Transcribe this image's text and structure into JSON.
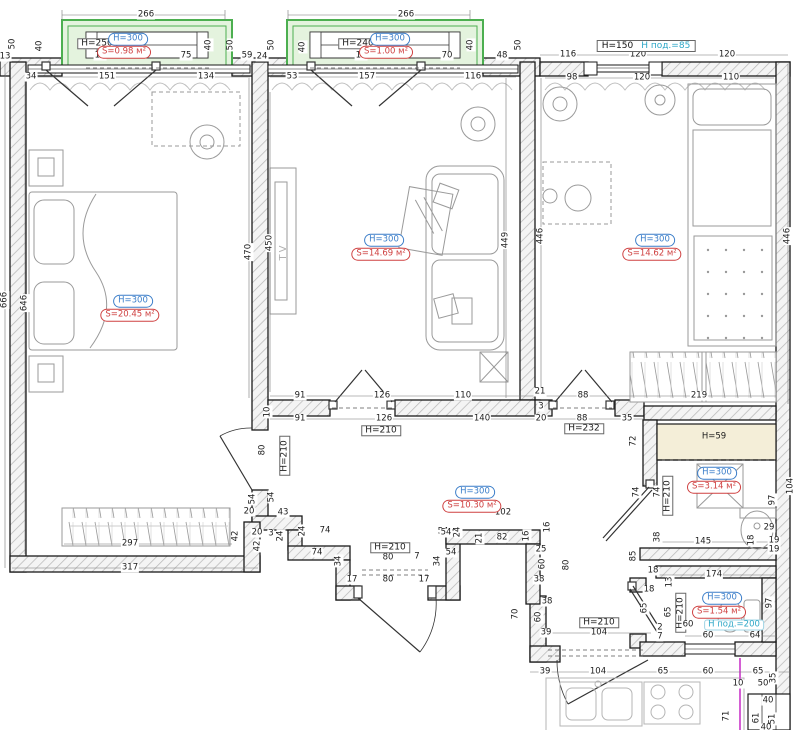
{
  "title": "apartment-floor-plan",
  "colors": {
    "wall_line": "#1a1a1a",
    "hatch": "#b9b9b9",
    "balcony_green": "#4caf50",
    "balcony_fill": "#e4f3de",
    "label_blue": "#3a7dc9",
    "label_red": "#cf4040",
    "teal": "#2da7c7",
    "shaft_fill": "#f4eed8",
    "furniture": "#9a9a9a",
    "magenta": "#d45fd4"
  },
  "window_label": {
    "h": "H=150",
    "sub": "Н под.=85"
  },
  "shaft_label": "H=59",
  "rooms": [
    {
      "id": "bedroom",
      "h": "H=300",
      "s": "S=20.45 м²",
      "hx": 133,
      "hy": 301,
      "sx": 130,
      "sy": 315
    },
    {
      "id": "living",
      "h": "H=300",
      "s": "S=14.69 м²",
      "hx": 384,
      "hy": 240,
      "sx": 381,
      "sy": 254
    },
    {
      "id": "bedroom-2",
      "h": "H=300",
      "s": "S=14.62 м²",
      "hx": 655,
      "hy": 240,
      "sx": 652,
      "sy": 254
    },
    {
      "id": "hallway",
      "h": "H=300",
      "s": "S=10.30 м²",
      "hx": 475,
      "hy": 492,
      "sx": 472,
      "sy": 506
    },
    {
      "id": "bathroom",
      "h": "H=300",
      "s": "S=3.14 м²",
      "hx": 717,
      "hy": 473,
      "sx": 714,
      "sy": 487
    },
    {
      "id": "wc",
      "h": "H=300",
      "s": "S=1.54 м²",
      "hx": 722,
      "hy": 598,
      "sx": 719,
      "sy": 612
    },
    {
      "id": "balcony-1",
      "h": "H=300",
      "s": "S=0.98 м²",
      "hx": 128,
      "hy": 39,
      "sx": 124,
      "sy": 52
    },
    {
      "id": "balcony-2",
      "h": "H=300",
      "s": "S=1.00 м²",
      "hx": 390,
      "hy": 39,
      "sx": 386,
      "sy": 52
    }
  ],
  "dimensions": [
    {
      "t": "266",
      "x": 146,
      "y": 15
    },
    {
      "t": "50",
      "x": 13,
      "y": 44,
      "v": 1
    },
    {
      "t": "13",
      "x": 5,
      "y": 57
    },
    {
      "t": "40",
      "x": 40,
      "y": 46,
      "v": 1
    },
    {
      "t": "H=250",
      "x": 97,
      "y": 44,
      "cls": "hbox"
    },
    {
      "t": "15",
      "x": 100,
      "y": 56
    },
    {
      "t": "75",
      "x": 186,
      "y": 56
    },
    {
      "t": "40",
      "x": 209,
      "y": 45,
      "v": 1
    },
    {
      "t": "50",
      "x": 231,
      "y": 45,
      "v": 1
    },
    {
      "t": "59",
      "x": 247,
      "y": 56
    },
    {
      "t": "34",
      "x": 31,
      "y": 77
    },
    {
      "t": "151",
      "x": 107,
      "y": 77
    },
    {
      "t": "134",
      "x": 206,
      "y": 77
    },
    {
      "t": "266",
      "x": 406,
      "y": 15
    },
    {
      "t": "50",
      "x": 272,
      "y": 45,
      "v": 1
    },
    {
      "t": "24",
      "x": 262,
      "y": 57
    },
    {
      "t": "40",
      "x": 303,
      "y": 47,
      "v": 1
    },
    {
      "t": "H=240",
      "x": 358,
      "y": 44,
      "cls": "hbox"
    },
    {
      "t": "15",
      "x": 361,
      "y": 56
    },
    {
      "t": "70",
      "x": 447,
      "y": 56
    },
    {
      "t": "40",
      "x": 471,
      "y": 45,
      "v": 1
    },
    {
      "t": "50",
      "x": 519,
      "y": 45,
      "v": 1
    },
    {
      "t": "48",
      "x": 502,
      "y": 56
    },
    {
      "t": "53",
      "x": 292,
      "y": 77
    },
    {
      "t": "157",
      "x": 367,
      "y": 77
    },
    {
      "t": "116",
      "x": 473,
      "y": 77
    },
    {
      "t": "116",
      "x": 568,
      "y": 55
    },
    {
      "t": "120",
      "x": 638,
      "y": 55
    },
    {
      "t": "120",
      "x": 727,
      "y": 55
    },
    {
      "t": "98",
      "x": 572,
      "y": 78
    },
    {
      "t": "120",
      "x": 642,
      "y": 78
    },
    {
      "t": "110",
      "x": 731,
      "y": 78
    },
    {
      "t": "666",
      "x": 5,
      "y": 300,
      "v": 1
    },
    {
      "t": "646",
      "x": 25,
      "y": 303,
      "v": 1
    },
    {
      "t": "470",
      "x": 249,
      "y": 252,
      "v": 1
    },
    {
      "t": "450",
      "x": 270,
      "y": 243,
      "v": 1
    },
    {
      "t": "TV",
      "x": 284,
      "y": 252,
      "v": 1,
      "cls": "tvtext"
    },
    {
      "t": "449",
      "x": 506,
      "y": 240,
      "v": 1
    },
    {
      "t": "446",
      "x": 541,
      "y": 236,
      "v": 1
    },
    {
      "t": "446",
      "x": 788,
      "y": 236,
      "v": 1
    },
    {
      "t": "91",
      "x": 300,
      "y": 396
    },
    {
      "t": "126",
      "x": 382,
      "y": 396
    },
    {
      "t": "110",
      "x": 463,
      "y": 396
    },
    {
      "t": "21",
      "x": 540,
      "y": 392
    },
    {
      "t": "88",
      "x": 583,
      "y": 396
    },
    {
      "t": "219",
      "x": 699,
      "y": 396
    },
    {
      "t": "91",
      "x": 300,
      "y": 419
    },
    {
      "t": "126",
      "x": 384,
      "y": 419
    },
    {
      "t": "140",
      "x": 482,
      "y": 419
    },
    {
      "t": "3",
      "x": 541,
      "y": 407
    },
    {
      "t": "20",
      "x": 541,
      "y": 419
    },
    {
      "t": "88",
      "x": 582,
      "y": 419
    },
    {
      "t": "35",
      "x": 627,
      "y": 419
    },
    {
      "t": "H=210",
      "x": 381,
      "y": 431,
      "cls": "hbox"
    },
    {
      "t": "H=232",
      "x": 584,
      "y": 429,
      "cls": "hbox"
    },
    {
      "t": "72",
      "x": 634,
      "y": 441,
      "v": 1
    },
    {
      "t": "H=59",
      "x": 714,
      "y": 437,
      "cls": "plain"
    },
    {
      "t": "10",
      "x": 268,
      "y": 412,
      "v": 1
    },
    {
      "t": "80",
      "x": 263,
      "y": 450,
      "v": 1
    },
    {
      "t": "H=210",
      "x": 285,
      "y": 456,
      "v": 1,
      "cls": "hbox"
    },
    {
      "t": "74",
      "x": 637,
      "y": 492,
      "v": 1
    },
    {
      "t": "74",
      "x": 658,
      "y": 492,
      "v": 1
    },
    {
      "t": "H=210",
      "x": 668,
      "y": 496,
      "v": 1,
      "cls": "hbox"
    },
    {
      "t": "97",
      "x": 773,
      "y": 500,
      "v": 1
    },
    {
      "t": "29",
      "x": 769,
      "y": 528
    },
    {
      "t": "38",
      "x": 658,
      "y": 537,
      "v": 1
    },
    {
      "t": "145",
      "x": 703,
      "y": 542
    },
    {
      "t": "18",
      "x": 752,
      "y": 540,
      "v": 1
    },
    {
      "t": "19",
      "x": 774,
      "y": 541
    },
    {
      "t": "19",
      "x": 774,
      "y": 550
    },
    {
      "t": "104",
      "x": 791,
      "y": 486,
      "v": 1
    },
    {
      "t": "85",
      "x": 634,
      "y": 556,
      "v": 1
    },
    {
      "t": "102",
      "x": 503,
      "y": 513
    },
    {
      "t": "54",
      "x": 443,
      "y": 532
    },
    {
      "t": "16",
      "x": 527,
      "y": 536,
      "v": 1
    },
    {
      "t": "16",
      "x": 548,
      "y": 527,
      "v": 1
    },
    {
      "t": "21",
      "x": 480,
      "y": 538,
      "v": 1
    },
    {
      "t": "82",
      "x": 502,
      "y": 538
    },
    {
      "t": "25",
      "x": 541,
      "y": 550
    },
    {
      "t": "60",
      "x": 543,
      "y": 564,
      "v": 1
    },
    {
      "t": "80",
      "x": 567,
      "y": 565,
      "v": 1
    },
    {
      "t": "38",
      "x": 539,
      "y": 580
    },
    {
      "t": "38",
      "x": 547,
      "y": 602
    },
    {
      "t": "60",
      "x": 539,
      "y": 617,
      "v": 1
    },
    {
      "t": "70",
      "x": 516,
      "y": 614,
      "v": 1
    },
    {
      "t": "39",
      "x": 546,
      "y": 633
    },
    {
      "t": "H=210",
      "x": 599,
      "y": 623,
      "cls": "hbox"
    },
    {
      "t": "104",
      "x": 599,
      "y": 633
    },
    {
      "t": "297",
      "x": 130,
      "y": 544
    },
    {
      "t": "317",
      "x": 130,
      "y": 568
    },
    {
      "t": "42",
      "x": 236,
      "y": 536,
      "v": 1
    },
    {
      "t": "20",
      "x": 249,
      "y": 512
    },
    {
      "t": "54",
      "x": 253,
      "y": 499,
      "v": 1
    },
    {
      "t": "54",
      "x": 272,
      "y": 497,
      "v": 1
    },
    {
      "t": "20",
      "x": 257,
      "y": 533
    },
    {
      "t": "3",
      "x": 271,
      "y": 534
    },
    {
      "t": "24",
      "x": 281,
      "y": 536,
      "v": 1
    },
    {
      "t": "42",
      "x": 258,
      "y": 546,
      "v": 1
    },
    {
      "t": "43",
      "x": 283,
      "y": 513
    },
    {
      "t": "24",
      "x": 303,
      "y": 531,
      "v": 1
    },
    {
      "t": "74",
      "x": 325,
      "y": 531
    },
    {
      "t": "74",
      "x": 317,
      "y": 553
    },
    {
      "t": "34",
      "x": 339,
      "y": 561,
      "v": 1
    },
    {
      "t": "17",
      "x": 352,
      "y": 580
    },
    {
      "t": "80",
      "x": 388,
      "y": 580
    },
    {
      "t": "17",
      "x": 424,
      "y": 580
    },
    {
      "t": "80",
      "x": 388,
      "y": 558
    },
    {
      "t": "7",
      "x": 417,
      "y": 557
    },
    {
      "t": "H=210",
      "x": 390,
      "y": 548,
      "cls": "hbox"
    },
    {
      "t": "54",
      "x": 446,
      "y": 533
    },
    {
      "t": "24",
      "x": 458,
      "y": 532,
      "v": 1
    },
    {
      "t": "54",
      "x": 451,
      "y": 553
    },
    {
      "t": "34",
      "x": 438,
      "y": 561,
      "v": 1
    },
    {
      "t": "18",
      "x": 653,
      "y": 571
    },
    {
      "t": "174",
      "x": 714,
      "y": 575
    },
    {
      "t": "13",
      "x": 670,
      "y": 582,
      "v": 1
    },
    {
      "t": "18",
      "x": 649,
      "y": 590
    },
    {
      "t": "65",
      "x": 645,
      "y": 608,
      "v": 1
    },
    {
      "t": "65",
      "x": 669,
      "y": 612,
      "v": 1
    },
    {
      "t": "H=210",
      "x": 681,
      "y": 613,
      "v": 1,
      "cls": "hbox"
    },
    {
      "t": "2",
      "x": 660,
      "y": 628
    },
    {
      "t": "7",
      "x": 660,
      "y": 637
    },
    {
      "t": "60",
      "x": 688,
      "y": 625
    },
    {
      "t": "Н под.=200",
      "x": 734,
      "y": 625,
      "cls": "teal"
    },
    {
      "t": "60",
      "x": 708,
      "y": 636
    },
    {
      "t": "64",
      "x": 755,
      "y": 636
    },
    {
      "t": "97",
      "x": 770,
      "y": 603,
      "v": 1
    },
    {
      "t": "39",
      "x": 545,
      "y": 672
    },
    {
      "t": "104",
      "x": 598,
      "y": 672
    },
    {
      "t": "65",
      "x": 663,
      "y": 672
    },
    {
      "t": "60",
      "x": 708,
      "y": 672
    },
    {
      "t": "65",
      "x": 758,
      "y": 672
    },
    {
      "t": "10",
      "x": 738,
      "y": 684
    },
    {
      "t": "50",
      "x": 763,
      "y": 684
    },
    {
      "t": "35",
      "x": 774,
      "y": 678,
      "v": 1
    },
    {
      "t": "40",
      "x": 768,
      "y": 701
    },
    {
      "t": "61",
      "x": 757,
      "y": 718,
      "v": 1
    },
    {
      "t": "51",
      "x": 773,
      "y": 719,
      "v": 1
    },
    {
      "t": "71",
      "x": 727,
      "y": 716,
      "v": 1
    },
    {
      "t": "40",
      "x": 766,
      "y": 728
    }
  ]
}
